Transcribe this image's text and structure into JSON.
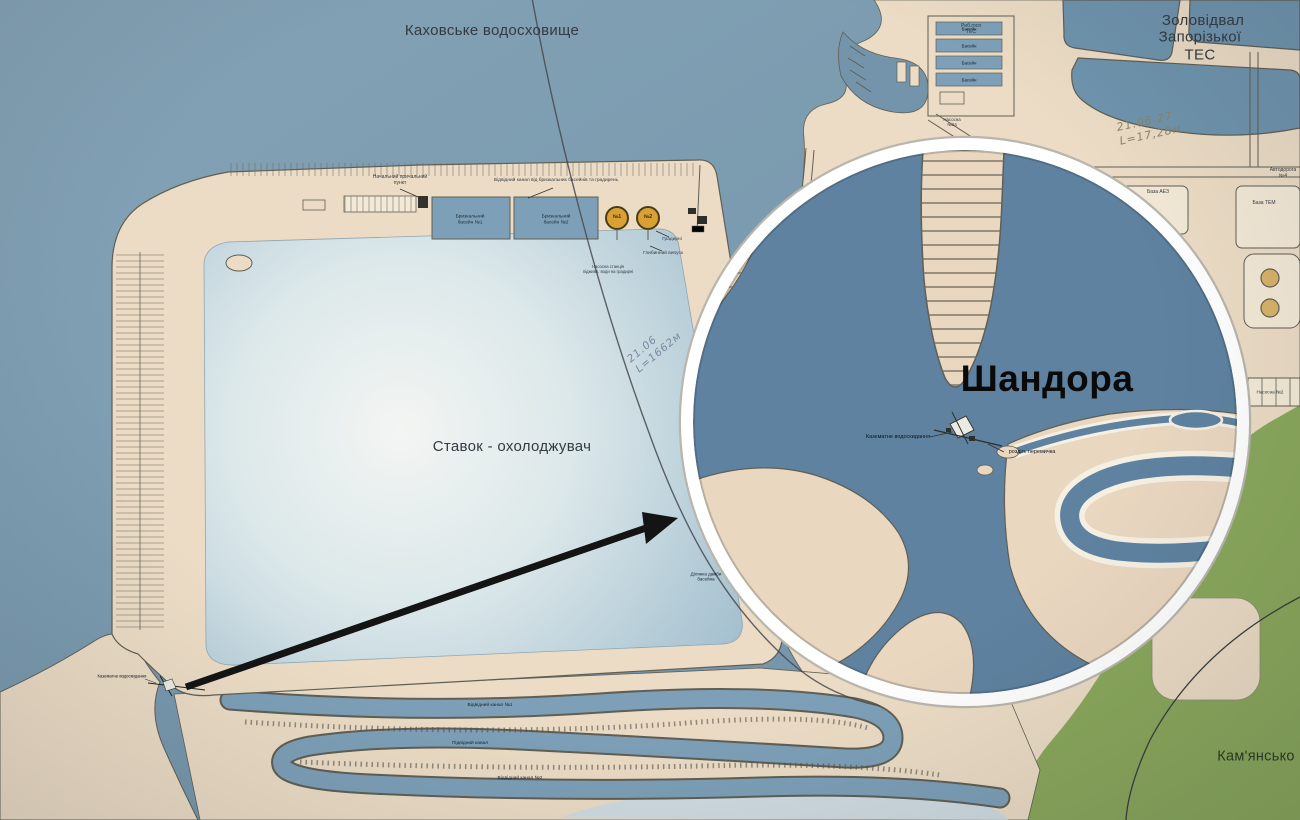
{
  "title_labels": {
    "reservoir": "Каховське водосховище",
    "ash_dump_line1": "Золовідвал",
    "ash_dump_line2": "Запорізької ТЕС",
    "pond": "Ставок - охолоджувач",
    "inset_title": "Шандора",
    "bottom_right_region": "Кам'янсько"
  },
  "small_labels": [
    {
      "name": "label-berth-point",
      "text": "Начальний причальний\nпункт",
      "x": 400,
      "y": 181,
      "size": 5
    },
    {
      "name": "label-outlet-canal",
      "text": "Відвідний канал від бризкальних басейнів та градирень",
      "x": 556,
      "y": 181,
      "size": 4.8
    },
    {
      "name": "label-spray-basin-1",
      "text": "Бризкальний\nбасейн №1",
      "x": 470,
      "y": 220,
      "size": 4.8,
      "color": "#1d2a36"
    },
    {
      "name": "label-spray-basin-2",
      "text": "Бризкальний\nбасейн №2",
      "x": 556,
      "y": 220,
      "size": 4.8,
      "color": "#1d2a36"
    },
    {
      "name": "label-tower-1",
      "text": "№1",
      "x": 617,
      "y": 218,
      "size": 5,
      "bold": true,
      "color": "#3a2c10"
    },
    {
      "name": "label-tower-2",
      "text": "№2",
      "x": 648,
      "y": 218,
      "size": 5,
      "bold": true,
      "color": "#3a2c10"
    },
    {
      "name": "label-cooling-towers",
      "text": "Градирні",
      "x": 672,
      "y": 240,
      "size": 4.8
    },
    {
      "name": "label-deep-outlet",
      "text": "Глибинний випуск",
      "x": 663,
      "y": 254,
      "size": 4.8
    },
    {
      "name": "label-pump-station-top",
      "text": "Насосна станція\nпідживл. води на градирні",
      "x": 608,
      "y": 270,
      "size": 4.2
    },
    {
      "name": "label-fish-farm",
      "text": "Риб.госп\nТЕС",
      "x": 971,
      "y": 30,
      "size": 5
    },
    {
      "name": "label-fish-basin-1",
      "text": "Басейн",
      "x": 969,
      "y": 29,
      "size": 4.4,
      "color": "#102030"
    },
    {
      "name": "label-fish-basin-2",
      "text": "Басейн",
      "x": 969,
      "y": 46,
      "size": 4.4,
      "color": "#102030"
    },
    {
      "name": "label-fish-basin-3",
      "text": "Басейн",
      "x": 969,
      "y": 63,
      "size": 4.4,
      "color": "#102030"
    },
    {
      "name": "label-fish-basin-4",
      "text": "Басейн",
      "x": 969,
      "y": 80,
      "size": 4.4,
      "color": "#102030"
    },
    {
      "name": "label-pump-24",
      "text": "Насосна\n№24",
      "x": 952,
      "y": 122,
      "size": 4.4
    },
    {
      "name": "label-road-4",
      "text": "Автодорога №4",
      "x": 1283,
      "y": 174,
      "size": 5
    },
    {
      "name": "label-base-aez",
      "text": "База АЕЗ",
      "x": 1158,
      "y": 193,
      "size": 5
    },
    {
      "name": "label-base-tem",
      "text": "База ТЕМ",
      "x": 1264,
      "y": 204,
      "size": 5
    },
    {
      "name": "label-pump-2",
      "text": "Насосна №2",
      "x": 1270,
      "y": 392,
      "size": 4.6
    },
    {
      "name": "label-serpentine-canal-1",
      "text": "Відвідний канал №1",
      "x": 490,
      "y": 706,
      "size": 4.8,
      "color": "#16222e"
    },
    {
      "name": "label-serpentine-canal-2",
      "text": "Підвідний канал",
      "x": 470,
      "y": 744,
      "size": 4.8,
      "color": "#16222e"
    },
    {
      "name": "label-serpentine-canal-3",
      "text": "Відвідний канал №2",
      "x": 520,
      "y": 779,
      "size": 4.8,
      "color": "#16222e"
    },
    {
      "name": "label-dam-section",
      "text": "Ділянка дамби\nбасейна",
      "x": 706,
      "y": 577,
      "size": 4.5,
      "color": "#16222e"
    },
    {
      "name": "label-intake-main-map",
      "text": "Казематне водоскидання",
      "x": 122,
      "y": 677,
      "size": 4.2,
      "color": "#0e141a"
    },
    {
      "name": "label-inset-intake",
      "text": "Казематне водоскидання",
      "x": 898,
      "y": 437,
      "size": 5.5,
      "color": "#10161c"
    },
    {
      "name": "label-inset-dike",
      "text": "розділ. перемичка",
      "x": 1032,
      "y": 452,
      "size": 5.5,
      "color": "#10161c"
    }
  ],
  "handwriting": [
    {
      "name": "handwriting-length-pond",
      "text": "21.06\nL=1662м",
      "x": 655,
      "y": 348,
      "rotate": -40,
      "size": 10.5,
      "color": "#7d86a0"
    },
    {
      "name": "handwriting-length-dam",
      "text": "21.06.27   L=17,28м",
      "x": 1178,
      "y": 122,
      "rotate": -12,
      "size": 11,
      "color": "#8a8268"
    }
  ],
  "colors": {
    "water": "#7394aa",
    "water_light": "#85a3b6",
    "land": "#ecdcc5",
    "land_light": "#f3e9d6",
    "outline": "#5f5f54",
    "green": "#8aa85c",
    "inset_water": "#5e82a0",
    "inset_land": "#ead7c0",
    "inset_casing": "#f6f0e3",
    "ring": "#ffffff",
    "basin_blue": "#7da0b8",
    "ash_blue": "#6f94ad",
    "orange": "#d9a033",
    "arrow": "#141414",
    "text_dark": "#343a41",
    "pond_center": "#f3f5f3",
    "pond_edge": "#9cbacb"
  }
}
